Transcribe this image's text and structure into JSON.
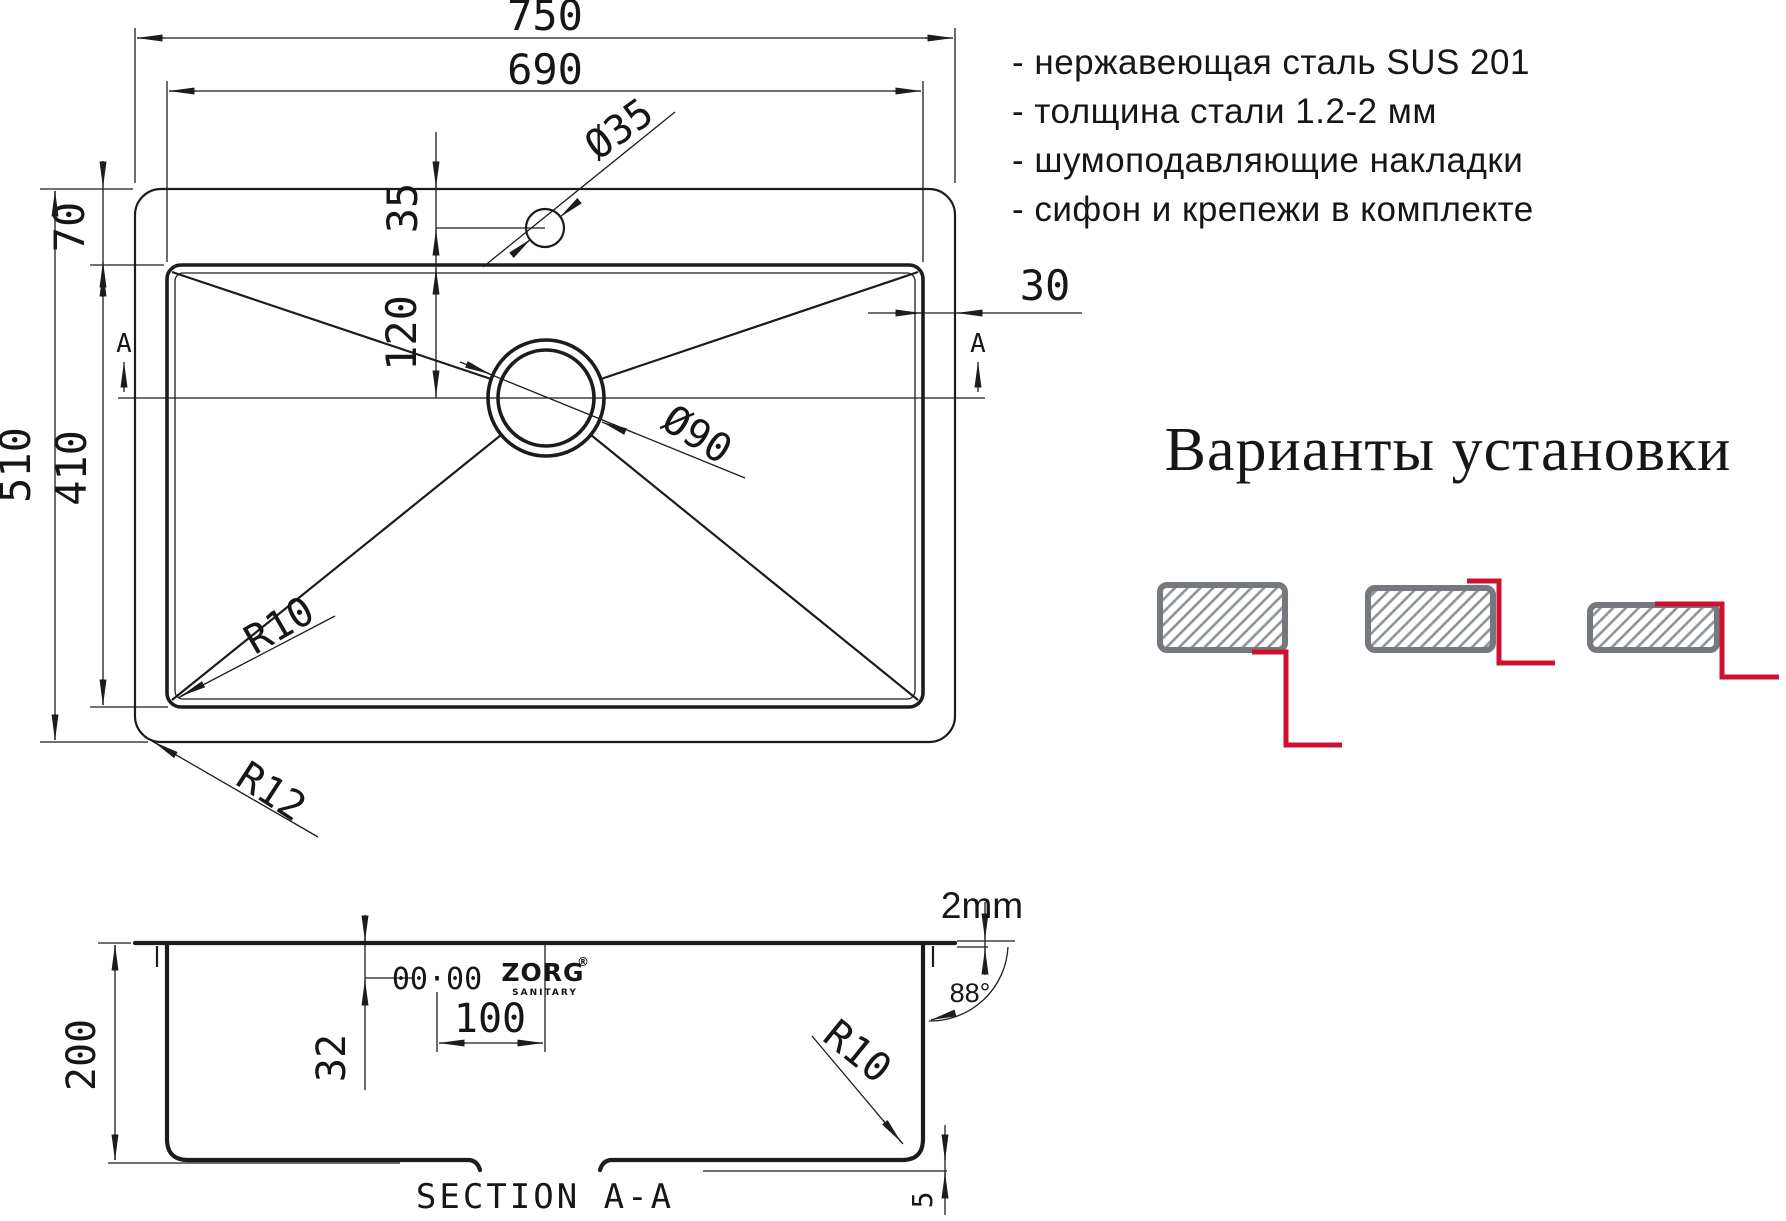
{
  "specs": {
    "items": [
      "- нержавеющая сталь SUS 201",
      "- толщина стали 1.2-2 мм",
      "- шумоподавляющие накладки",
      "- сифон и крепежи в комплекте"
    ]
  },
  "installation": {
    "heading": "Варианты установки"
  },
  "top_view": {
    "dim_width_overall": "750",
    "dim_width_bowl": "690",
    "dim_hole_offset": "35",
    "dim_drain_offset": "120",
    "dim_rim_offset": "70",
    "dim_depth_overall": "510",
    "dim_depth_bowl": "410",
    "dim_edge_gap": "30",
    "label_hole": "Ø35",
    "label_drain": "Ø90",
    "label_corner_radius": "R10",
    "label_rim_radius": "R12",
    "section_marker": "A"
  },
  "section_view": {
    "dim_height": "200",
    "dim_clip_offset": "32",
    "dim_clip_span": "100",
    "label_clip_holes": "00·00",
    "dim_thickness": "2mm",
    "dim_wall_angle": "88°",
    "label_bottom_radius": "R10",
    "dim_lip": "5",
    "title": "SECTION A-A",
    "logo": "ZORG",
    "logo_sub": "SANITARY",
    "logo_reg": "®"
  },
  "colors": {
    "line": "#1c1c1c",
    "red": "#cd1230",
    "gray_border": "#75797d",
    "gray_hatch": "#8d9296"
  }
}
